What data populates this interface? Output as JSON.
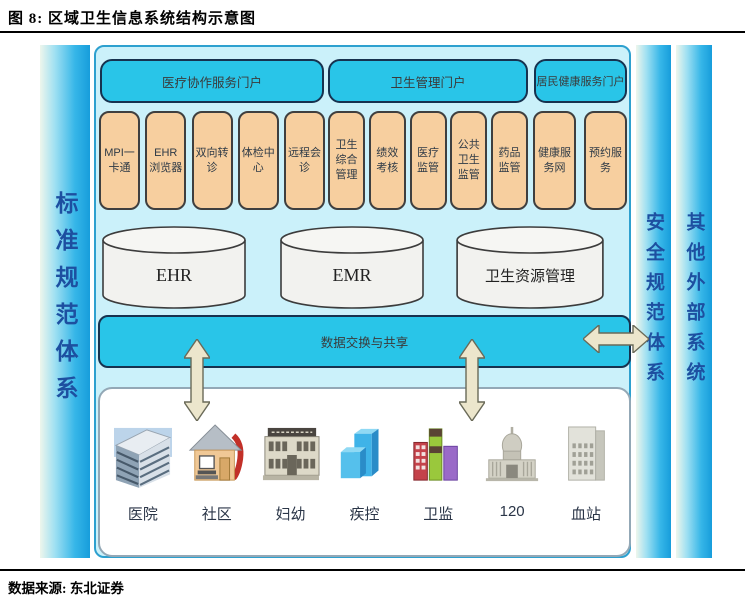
{
  "header": {
    "title": "图 8: 区域卫生信息系统结构示意图"
  },
  "footer": {
    "source": "数据来源: 东北证券"
  },
  "diagram": {
    "left_bar": "标准规范体系",
    "security_bar": "安全规范体系",
    "external_bar": "其他外部系统",
    "portals": [
      "医疗协作服务门户",
      "卫生管理门户",
      "居民健康服务门户"
    ],
    "modules": [
      "MPI一卡通",
      "EHR浏览器",
      "双向转诊",
      "体检中心",
      "远程会诊",
      "卫生综合管理",
      "绩效考核",
      "医疗监管",
      "公共卫生监管",
      "药品监管",
      "健康服务网",
      "预约服务"
    ],
    "databases": [
      "EHR",
      "EMR",
      "卫生资源管理"
    ],
    "exchange_bar": "数据交换与共享",
    "institutions": [
      {
        "label": "医院",
        "icon": "hospital-building-icon"
      },
      {
        "label": "社区",
        "icon": "community-house-icon"
      },
      {
        "label": "妇幼",
        "icon": "maternal-child-building-icon"
      },
      {
        "label": "疾控",
        "icon": "cdc-building-icon"
      },
      {
        "label": "卫监",
        "icon": "health-supervision-building-icon"
      },
      {
        "label": "120",
        "icon": "emergency-120-building-icon"
      },
      {
        "label": "血站",
        "icon": "blood-station-building-icon"
      }
    ],
    "colors": {
      "cyan": "#29c5e8",
      "panel_bg": "#cbf1fa",
      "module_bg": "#f7cf9f",
      "bar_gradient_start": "#eef6ec",
      "bar_gradient_end": "#179ddb",
      "arrow_fill": "#e8e2c4",
      "bar_text": "#1d4fa0"
    }
  }
}
